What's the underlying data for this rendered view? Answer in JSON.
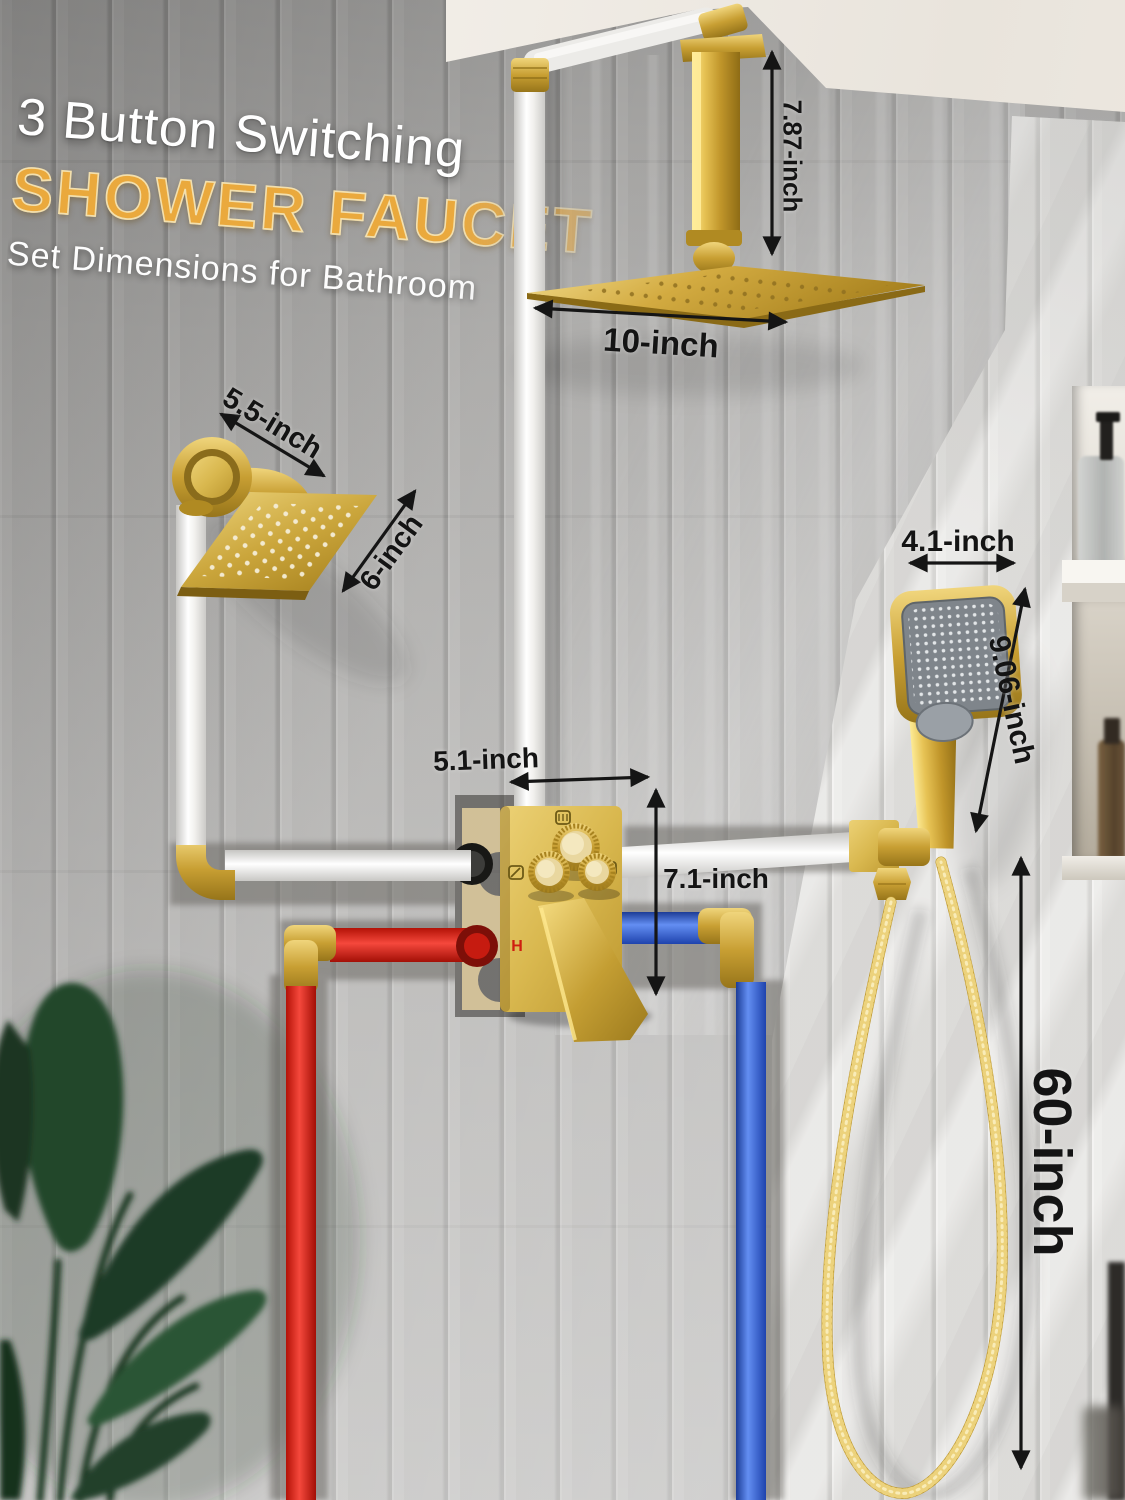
{
  "title": {
    "line1": "3 Button Switching",
    "line2": "SHOWER FAUCET",
    "line3": "Set Dimensions for Bathroom"
  },
  "dimensions": {
    "ceiling_arm_height": "7.87-inch",
    "rain_shower_width": "10-inch",
    "wall_arm_length": "5.5-inch",
    "wall_shower_width": "6-inch",
    "handheld_width": "4.1-inch",
    "handheld_height": "9.06-inch",
    "valve_width": "5.1-inch",
    "valve_height": "7.1-inch",
    "hose_length": "60-inch"
  },
  "valve": {
    "hot_label": "H",
    "button_count": 3,
    "mode_icons": [
      "rain-mode-icon",
      "hand-shower-mode-icon",
      "tub-spout-mode-icon"
    ]
  },
  "colors": {
    "gold": "#c9a02f",
    "hot_pipe": "#e02520",
    "cold_pipe": "#2b59d8",
    "title_accent": "#eaa93d",
    "annotation": "#141414"
  }
}
